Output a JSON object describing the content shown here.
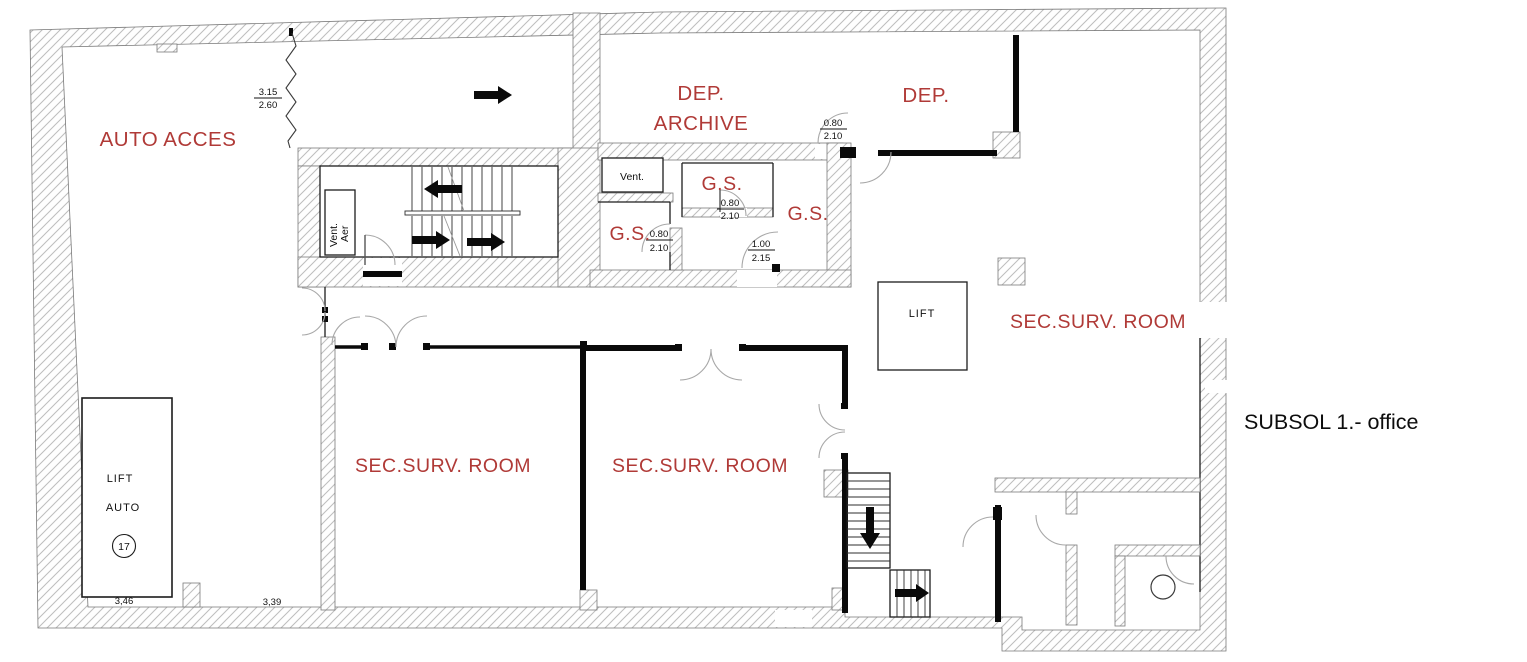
{
  "title": "SUBSOL 1.- office",
  "colors": {
    "room_label": "#b03a37",
    "wall_line": "#0a0a0a",
    "hatch_line": "#bdbdbd"
  },
  "labels": {
    "auto_acces": "AUTO ACCES",
    "dep_archive_line1": "DEP.",
    "dep_archive_line2": "ARCHIVE",
    "dep": "DEP.",
    "vent": "Vent.",
    "vent_aer_line1": "Vent.",
    "vent_aer_line2": "Aer",
    "gs_left": "G.S.",
    "gs_mid": "G.S.",
    "gs_right": "G.S.",
    "lift_shaft": "LIFT",
    "sec_surv_left": "SEC.SURV. ROOM",
    "sec_surv_mid": "SEC.SURV. ROOM",
    "sec_surv_right": "SEC.SURV. ROOM",
    "lift_auto_line1": "LIFT",
    "lift_auto_line2": "AUTO",
    "lift_auto_number": "17"
  },
  "dimensions": {
    "ramp_width": "3.15",
    "ramp_height": "2.60",
    "archive_door_width": "0.80",
    "archive_door_height": "2.10",
    "gs_mid_door_width": "0.80",
    "gs_mid_door_height": "2.10",
    "gs_left_door_width": "0.80",
    "gs_left_door_height": "2.10",
    "corridor_door_width": "1.00",
    "corridor_door_height": "2.15",
    "bay_left": "3,46",
    "bay_right": "3,39"
  }
}
